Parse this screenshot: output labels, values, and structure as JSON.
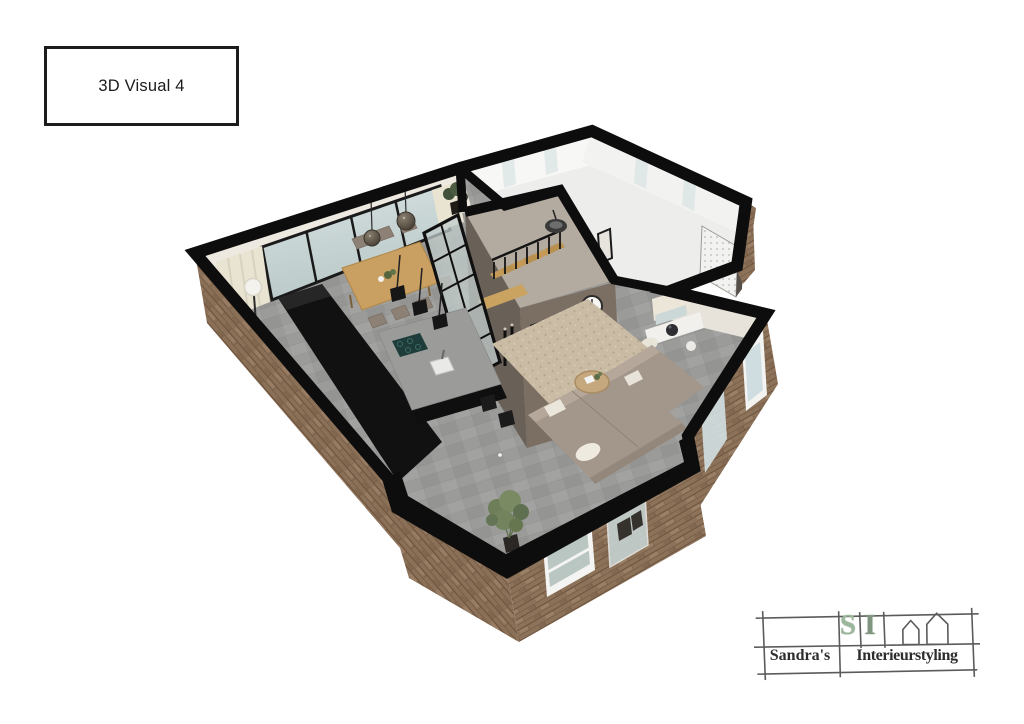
{
  "page": {
    "background_color": "#ffffff"
  },
  "title_box": {
    "label": "3D Visual 4"
  },
  "floorplan": {
    "type": "3d-cutaway-floorplan-render",
    "rooms": [
      "dining-area",
      "kitchen",
      "living-room",
      "hallway-with-stairs",
      "garage",
      "entrance-porch",
      "window-nook"
    ],
    "furniture": [
      "dining-table",
      "dining-chairs",
      "globe-pendant-lights",
      "floor-lamp",
      "kitchen-counter",
      "kitchen-island",
      "cooktop",
      "sink",
      "bar-stools",
      "cube-pendant-lights",
      "staircase",
      "stair-railing",
      "round-pendant-light",
      "glass-partition",
      "fireplace",
      "floating-shelf",
      "wall-clock",
      "candle-sticks",
      "corner-sofa",
      "throw-pillows",
      "area-rug",
      "coffee-table",
      "indoor-plant",
      "window-seat",
      "decor-vase",
      "speaker-boxes"
    ],
    "colors": {
      "wall_cut": "#0d0d0d",
      "brick": "#8b7058",
      "tile_floor": "#9b9b99",
      "garage_floor": "#ededeb",
      "block_wall": "#7b6e63",
      "wood": "#c59a58",
      "glass": "#cdd9d9",
      "curtain": "#e9e3d1",
      "sofa": "#a3968a",
      "rug": "#c9bba4",
      "plant": "#6d7e59"
    }
  },
  "logo": {
    "initial_s": "S",
    "initial_i": "I",
    "name_line1": "Sandra's",
    "name_line2": "Interieurstyling",
    "accent_green": "#9cb89c",
    "ink": "#2d2d2d"
  }
}
